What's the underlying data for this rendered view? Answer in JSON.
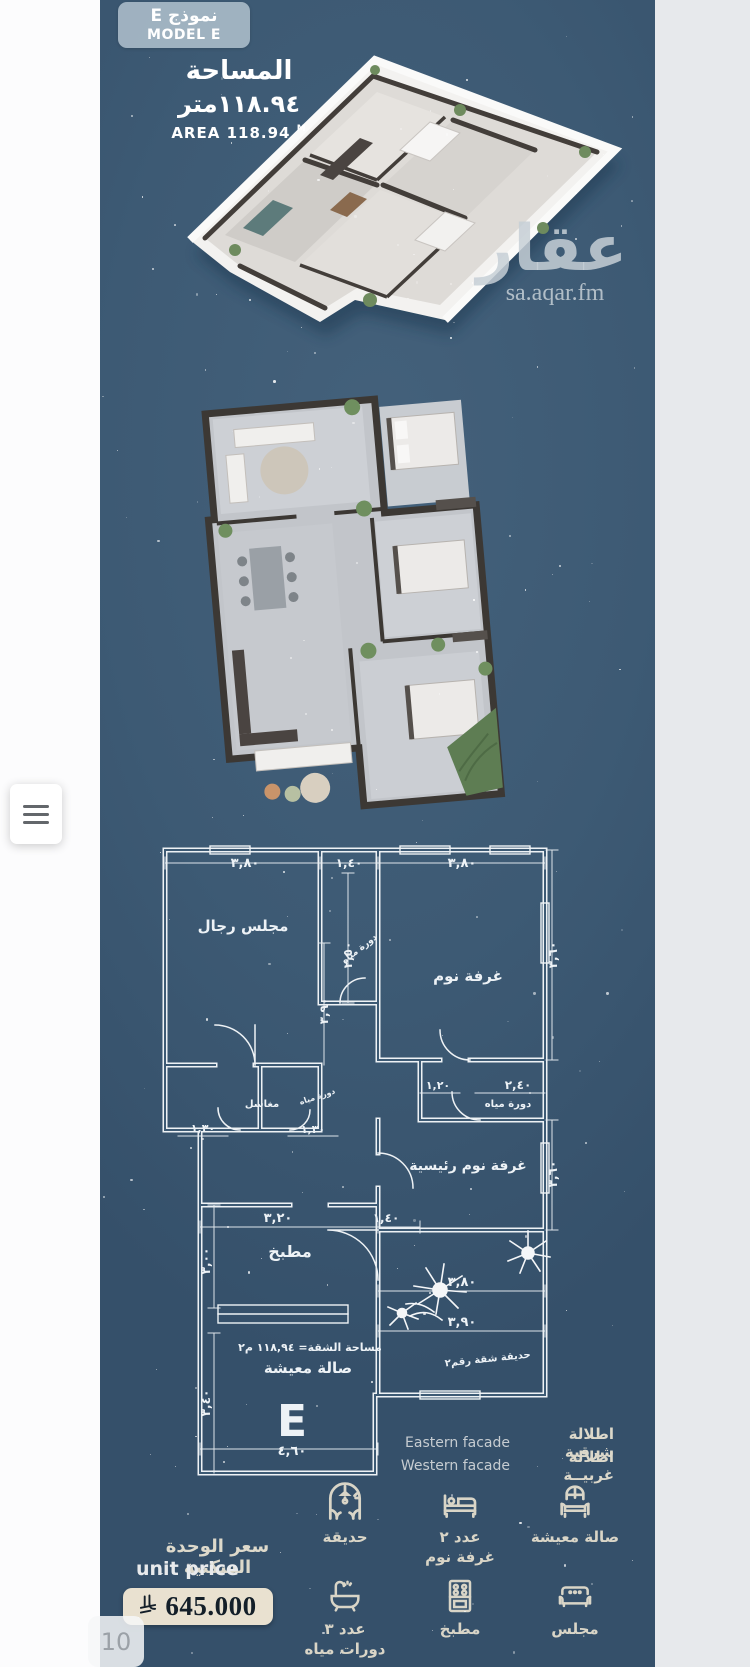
{
  "page": {
    "counter": "10"
  },
  "theme": {
    "poster_bg": "#3d5a74",
    "blueprint_line": "#edf2f6",
    "label_beige": "#d9d5c7",
    "price_pill_bg": "#e9e1d0"
  },
  "poster": {
    "badge": {
      "ar": "نموذج E",
      "en": "MODEL E"
    },
    "area": {
      "label_ar": "المساحة",
      "value_ar": "١١٨.٩٤متر",
      "label_en": "AREA",
      "value_en": "118.94",
      "unit_en": "M"
    },
    "watermark": {
      "logo": "عقار",
      "site": "sa.aqar.fm"
    },
    "blueprint": {
      "model_letter": "E",
      "labels": [
        {
          "t": "٣,٨٠",
          "x": 105,
          "y": 24,
          "s": 13
        },
        {
          "t": "١,٤٠",
          "x": 209,
          "y": 24,
          "s": 12
        },
        {
          "t": "٣,٨٠",
          "x": 322,
          "y": 24,
          "s": 13
        },
        {
          "t": "٢,٥٠",
          "x": 212,
          "y": 112,
          "s": 12,
          "r": -90
        },
        {
          "t": "٣,٩٠",
          "x": 188,
          "y": 168,
          "s": 12,
          "r": -90
        },
        {
          "t": "٣,٦٠",
          "x": 417,
          "y": 112,
          "s": 12,
          "r": -90
        },
        {
          "t": "مجلس رجال",
          "x": 103,
          "y": 88,
          "s": 15
        },
        {
          "t": "دورة مياه",
          "x": 221,
          "y": 108,
          "s": 9,
          "r": -38
        },
        {
          "t": "غرفة نوم",
          "x": 328,
          "y": 138,
          "s": 15
        },
        {
          "t": "مغاسل",
          "x": 122,
          "y": 264,
          "s": 10
        },
        {
          "t": "دورة مياه",
          "x": 178,
          "y": 256,
          "s": 8,
          "r": -18
        },
        {
          "t": "١,٣٠",
          "x": 63,
          "y": 289,
          "s": 11
        },
        {
          "t": "١,٣٠",
          "x": 173,
          "y": 290,
          "s": 11
        },
        {
          "t": "١,٢٠",
          "x": 298,
          "y": 246,
          "s": 11
        },
        {
          "t": "٢,٤٠",
          "x": 378,
          "y": 246,
          "s": 12
        },
        {
          "t": "دورة مياه",
          "x": 368,
          "y": 264,
          "s": 10
        },
        {
          "t": "غرفة نوم رئيسية",
          "x": 328,
          "y": 327,
          "s": 14
        },
        {
          "t": "٣,٦٠",
          "x": 417,
          "y": 331,
          "s": 12,
          "r": -90
        },
        {
          "t": "٣,٢٠",
          "x": 138,
          "y": 379,
          "s": 13
        },
        {
          "t": "١,٤٠",
          "x": 246,
          "y": 379,
          "s": 12
        },
        {
          "t": "مطبخ",
          "x": 150,
          "y": 414,
          "s": 16
        },
        {
          "t": "٣,٠٠",
          "x": 70,
          "y": 418,
          "s": 12,
          "r": -90
        },
        {
          "t": "٣,٨٠",
          "x": 322,
          "y": 443,
          "s": 13
        },
        {
          "t": "٣,٩٠",
          "x": 322,
          "y": 483,
          "s": 13
        },
        {
          "t": "حديقة شقة رقم٢",
          "x": 348,
          "y": 519,
          "s": 10,
          "r": -6
        },
        {
          "t": "مساحة الشقة= ١١٨,٩٤ م٢",
          "x": 170,
          "y": 508,
          "s": 11
        },
        {
          "t": "صالة معيشة",
          "x": 168,
          "y": 530,
          "s": 15
        },
        {
          "t": "E",
          "x": 152,
          "y": 593,
          "s": 44,
          "w": "800"
        },
        {
          "t": "٤,٦٠",
          "x": 152,
          "y": 612,
          "s": 13
        },
        {
          "t": "٣,٤٠",
          "x": 70,
          "y": 560,
          "s": 12,
          "r": -90
        }
      ]
    },
    "facade": {
      "rows": [
        {
          "en": "Eastern facade",
          "ar": "اطلالة شرقية"
        },
        {
          "en": "Western facade",
          "ar": "اطلالة غربيــة"
        }
      ]
    },
    "features": [
      {
        "icon": "living-room",
        "label1": "صالة معيشة",
        "label2": ""
      },
      {
        "icon": "bedrooms",
        "label1": "عدد ٢",
        "label2": "غرفة نوم"
      },
      {
        "icon": "garden",
        "label1": "حديقة",
        "label2": ""
      },
      {
        "icon": "majlis",
        "label1": "مجلس",
        "label2": ""
      },
      {
        "icon": "kitchen",
        "label1": "مطبخ",
        "label2": ""
      },
      {
        "icon": "bathrooms",
        "label1": "عدد ٣",
        "label2": "دورات مياه"
      }
    ],
    "price": {
      "label_ar": "سعر الوحدة السكنية",
      "label_en": "unit price",
      "amount": "645.000"
    }
  }
}
